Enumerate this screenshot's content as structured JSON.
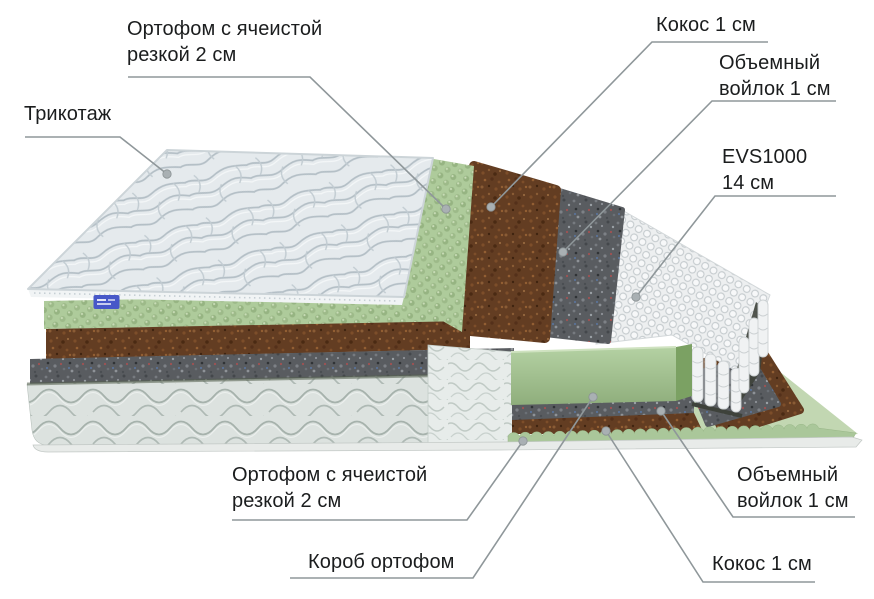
{
  "diagram": {
    "type": "mattress-layers-cutaway",
    "labels": {
      "tricot": {
        "text": "Трикотаж"
      },
      "orthofoam_top": {
        "line1": "Ортофом с ячеистой",
        "line2": "резкой 2 см"
      },
      "coconut_top": {
        "text": "Кокос 1 см"
      },
      "felt_top": {
        "line1": "Объемный",
        "line2": "войлок 1 см"
      },
      "evs": {
        "line1": "EVS1000",
        "line2": "14 см"
      },
      "orthofoam_bottom": {
        "line1": "Ортофом с ячеистой",
        "line2": "резкой 2 см"
      },
      "box": {
        "text": "Короб ортофом"
      },
      "felt_bottom": {
        "line1": "Объемный",
        "line2": "войлок 1 см"
      },
      "coconut_bottom": {
        "text": "Кокос 1 см"
      }
    },
    "layer_order_top_to_bottom": [
      "Трикотаж",
      "Ортофом с ячеистой резкой 2 см",
      "Кокос 1 см",
      "Объемный войлок 1 см",
      "EVS1000 14 см",
      "Объемный войлок 1 см",
      "Кокос 1 см",
      "Ортофом с ячеистой резкой 2 см",
      "Короб ортофом"
    ],
    "colors": {
      "background": "#ffffff",
      "text": "#1b1d1e",
      "leader_line": "#8f979a",
      "leader_dot": "#a9b0b3",
      "fabric_light": "#e5eaed",
      "foam_green": "#aecb9b",
      "foam_block_green": "#a3c292",
      "coconut_brown": "#633d22",
      "felt_gray": "#595c60",
      "spring_white": "#edeff0",
      "box_quilt": "#dde3e0",
      "tag_blue": "#4758c8"
    }
  }
}
